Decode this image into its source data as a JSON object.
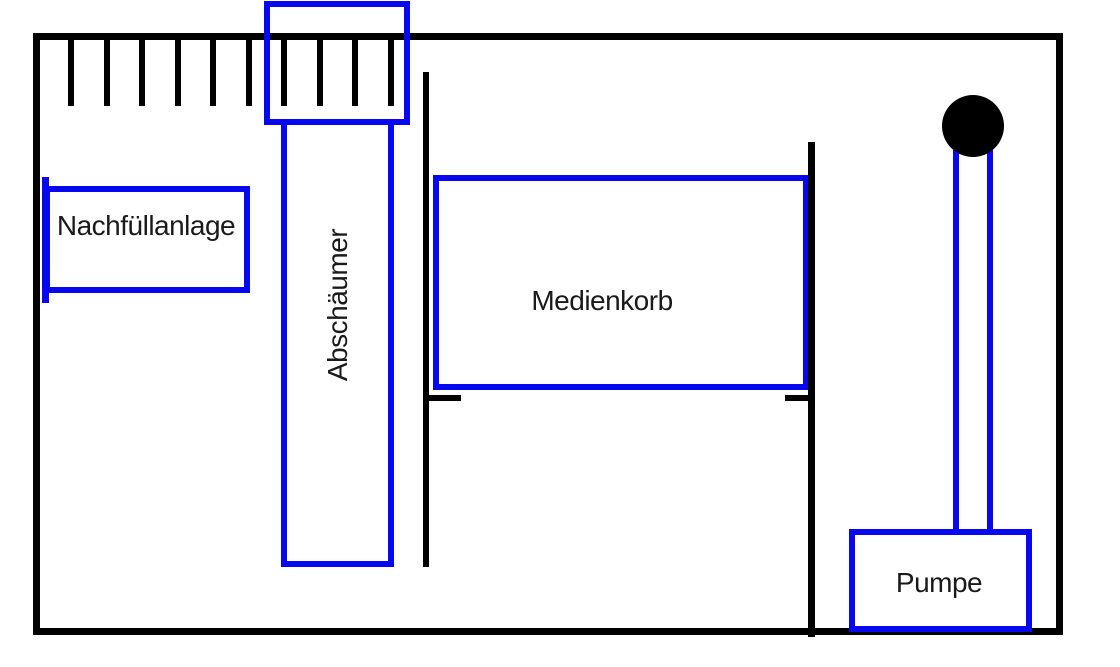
{
  "labels": {
    "refill_unit": "Nachfüllanlage",
    "skimmer": "Abschäumer",
    "media_basket": "Medienkorb",
    "pump": "Pumpe"
  },
  "colors": {
    "structure_black": "#000000",
    "component_blue": "#0808f0",
    "background": "#ffffff"
  }
}
